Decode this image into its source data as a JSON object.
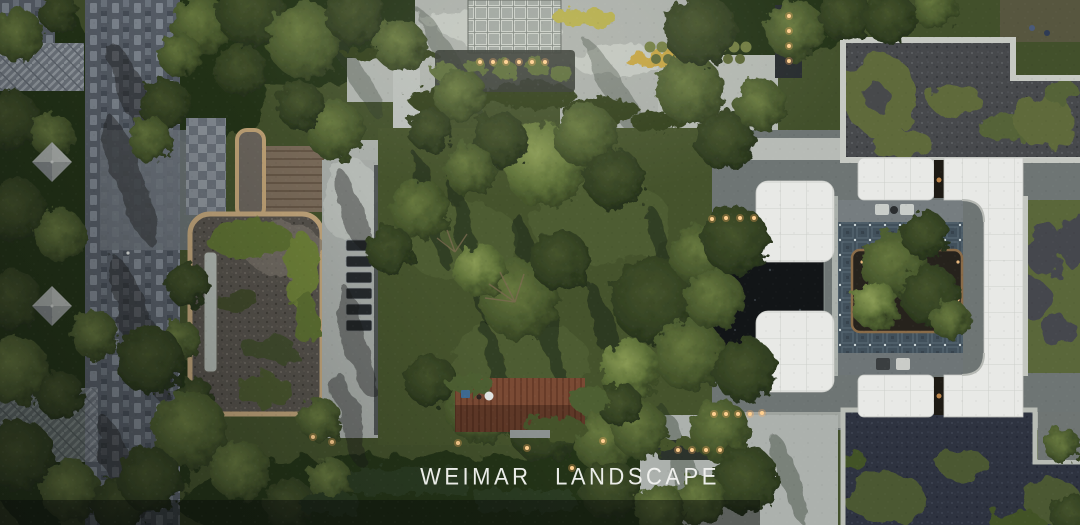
{
  "meta": {
    "type": "aerial-photograph",
    "subject": "Top-down aerial rendering of a residential courtyard landscape design"
  },
  "watermark": {
    "text": "WEIMAR LANDSCAPE",
    "color": "#f3f4f1"
  },
  "palette": {
    "lawn": "#45532c",
    "tree_dark": "#243018",
    "tree_light": "#6b7c45",
    "paving_light": "#aeb3af",
    "paving_striped": "#59606a",
    "herringbone": "#757c85",
    "pavilion_gravel": "#54504a",
    "pavilion_border_tan": "#c0a47a",
    "canopy_white": "#e8e9e6",
    "courtyard_tile": "#41505b",
    "pond": "#121517",
    "roof_garden_gravel": "#47494c",
    "roof_garden_navy": "#2e3340",
    "warm_light": "#ffcf8f"
  },
  "regions": [
    {
      "id": "left-walkway",
      "label": "striped stone walkway"
    },
    {
      "id": "herringbone-plaza",
      "label": "herringbone paved plaza"
    },
    {
      "id": "sun-umbrella",
      "label": "pyramid sun umbrella"
    },
    {
      "id": "pavilion-roof",
      "label": "pavilion roof with gravel and moss garden"
    },
    {
      "id": "roof-skylight",
      "label": "linear skylight strip"
    },
    {
      "id": "pavilion-corridor",
      "label": "covered corridor roof"
    },
    {
      "id": "tiled-roof",
      "label": "gray tiled roof"
    },
    {
      "id": "wood-deck",
      "label": "timber deck"
    },
    {
      "id": "lounge-chairs",
      "label": "row of lounge chairs"
    },
    {
      "id": "central-lawn",
      "label": "central lawn with mature trees"
    },
    {
      "id": "red-pergola",
      "label": "red cedar pergola"
    },
    {
      "id": "north-plaza",
      "label": "light stone plaza"
    },
    {
      "id": "lattice-roof",
      "label": "lattice pavilion roof"
    },
    {
      "id": "planter-lights",
      "label": "planter strip with path lights"
    },
    {
      "id": "flower-beds",
      "label": "yellow flower beds"
    },
    {
      "id": "topiary-row",
      "label": "rows of topiary spheres"
    },
    {
      "id": "water-channel",
      "label": "dark water channel with lights"
    },
    {
      "id": "entry-path",
      "label": "entry path"
    },
    {
      "id": "reflecting-pond",
      "label": "dark reflecting pond"
    },
    {
      "id": "courtyard-floor",
      "label": "patterned blue-gray courtyard floor"
    },
    {
      "id": "courtyard-island",
      "label": "central planted island"
    },
    {
      "id": "white-canopies",
      "label": "white flat canopies"
    },
    {
      "id": "curved-white-roof",
      "label": "curved white roof band"
    },
    {
      "id": "roof-garden-ne",
      "label": "gravel roof garden with organic lawn shapes"
    },
    {
      "id": "roof-garden-east",
      "label": "east roof garden strip"
    },
    {
      "id": "roof-garden-se",
      "label": "southeast roof garden with organic lawn shapes"
    },
    {
      "id": "outdoor-loungers",
      "label": "outdoor lounge chairs and side tables"
    },
    {
      "id": "path-lights",
      "label": "warm path lights"
    }
  ]
}
